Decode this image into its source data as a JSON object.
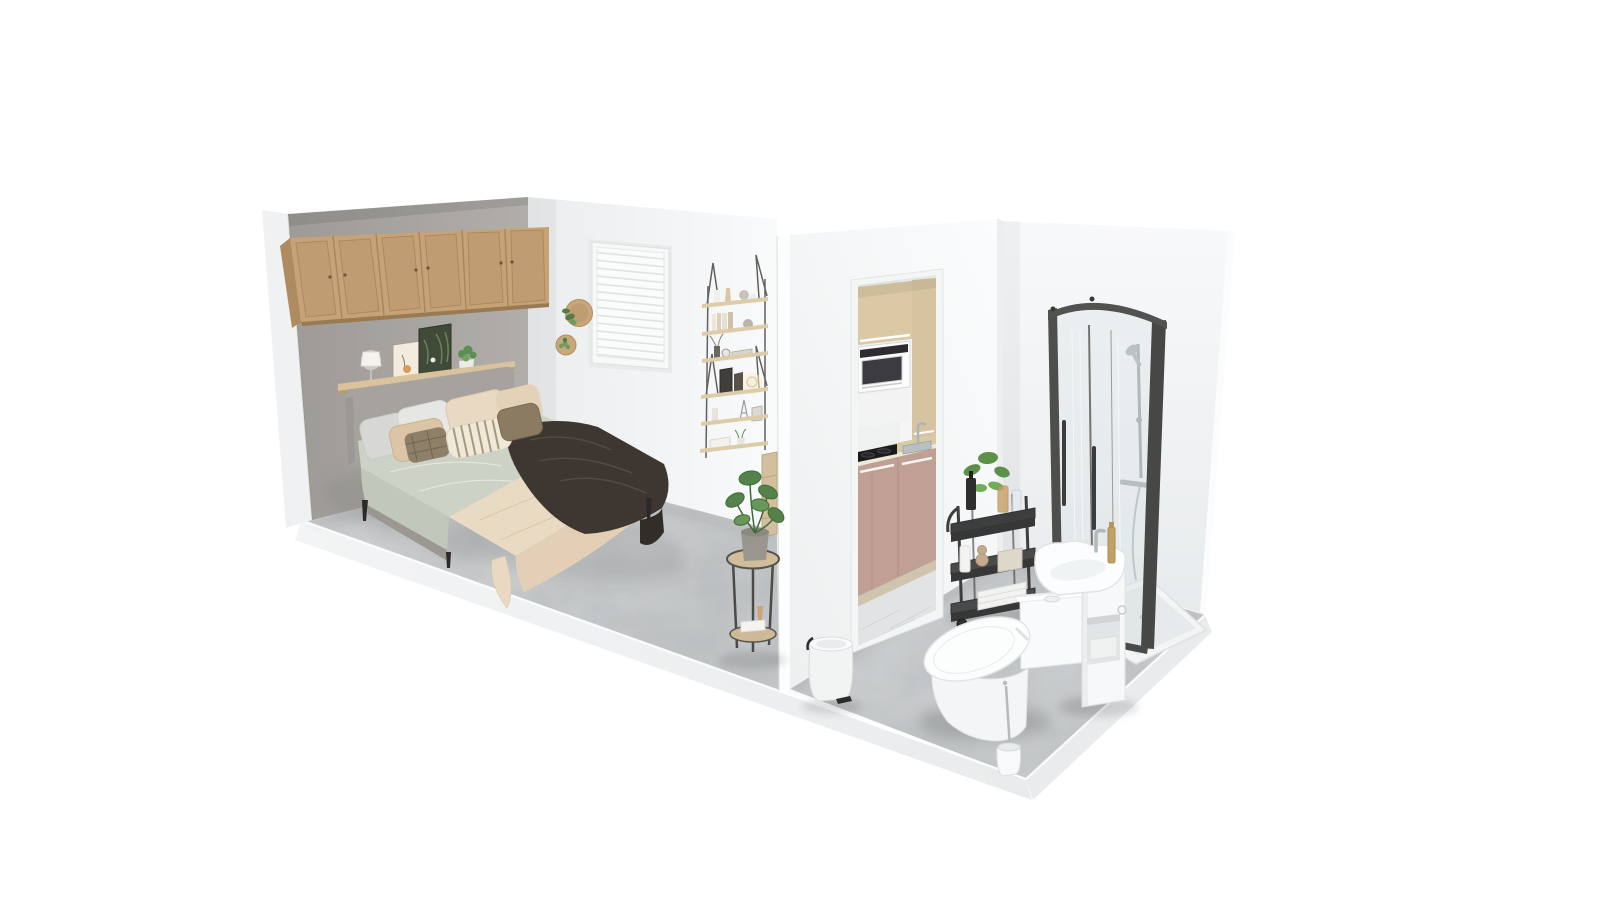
{
  "scene": {
    "type": "3d-isometric-dollhouse-render",
    "description": "Photorealistic 3D cutaway render of a studio apartment with a bedroom, a kitchenette seen through a doorway, and a bathroom, floating on a white background",
    "background": "#ffffff",
    "view": "elevated three-quarter view, no visible UI chrome"
  },
  "colors": {
    "background": "#ffffff",
    "accent_wall": "#a8a5a1",
    "wall_edge": "#eff1f2",
    "back_wall": "#f2f3f4",
    "partition_wall": "#f1f3f4",
    "partition_edge": "#fcfdfd",
    "right_wall": "#f3f5f6",
    "bedroom_floor": "#d0d2d3",
    "bathroom_floor": "#cbced0",
    "kitchen_floor": "#e2e3e4",
    "slab_front": "#eff1f2",
    "slab_side": "#e9ebed",
    "cabinet_wood": "#c7a277",
    "cabinet_wood_dark": "#a9855a",
    "shelf_wood": "#d9c29c",
    "ladder_shelf_wood": "#ddccaa",
    "headboard_gray": "#a6a39f",
    "duvet_sage": "#cdd2c7",
    "blanket_cream": "#e9dac3",
    "throw_dark": "#3e3731",
    "pillow_gray": "#d7d7d5",
    "pillow_cream": "#e9d9c2",
    "pillow_beige": "#dcc5a6",
    "pillow_taupe": "#8c7b63",
    "kitchen_upper_wood": "#dbc9a5",
    "kitchen_lower_blush": "#c0a094",
    "counter_wood": "#d9caa6",
    "cooktop_black": "#1b1b1e",
    "microwave_white": "#fbfbfb",
    "shower_frame": "#4e4e4c",
    "chrome": "#b2b9be",
    "porcelain": "#f9fafb",
    "cart_black": "#3e3e3e",
    "plant_green": "#5d9049",
    "monstera_green": "#55824a",
    "brass": "#c2a166",
    "window_blinds": "#fafbfb"
  },
  "rooms": {
    "bedroom": {
      "name": "bedroom",
      "items": [
        "double bed with grey upholstered frame",
        "six-door oak wall cabinet above bed",
        "floating picture ledge with lamp, two botanical prints and small plant",
        "grey accent wall",
        "window with closed white venetian blinds",
        "two round wall planters",
        "two stacked ladder wall shelves with books, vases, frames and glowing lamp",
        "stacked wooden boxes",
        "round two-tier side table with monstera plant, books and vase"
      ]
    },
    "kitchenette": {
      "name": "kitchenette through doorway",
      "items": [
        "oak upper cabinets",
        "built-in white microwave",
        "two-burner black cooktop",
        "inset sink with chrome tap",
        "blush lower cabinets",
        "marble floor"
      ]
    },
    "bathroom": {
      "name": "bathroom",
      "items": [
        "curved glass corner shower with dark frame",
        "hand shower on rail",
        "white shower tray",
        "white basin vanity with chrome tap and brass bottle",
        "one-piece toilet",
        "toilet brush",
        "white pedal bin",
        "black three-tier trolley with plant and toiletries"
      ]
    }
  }
}
